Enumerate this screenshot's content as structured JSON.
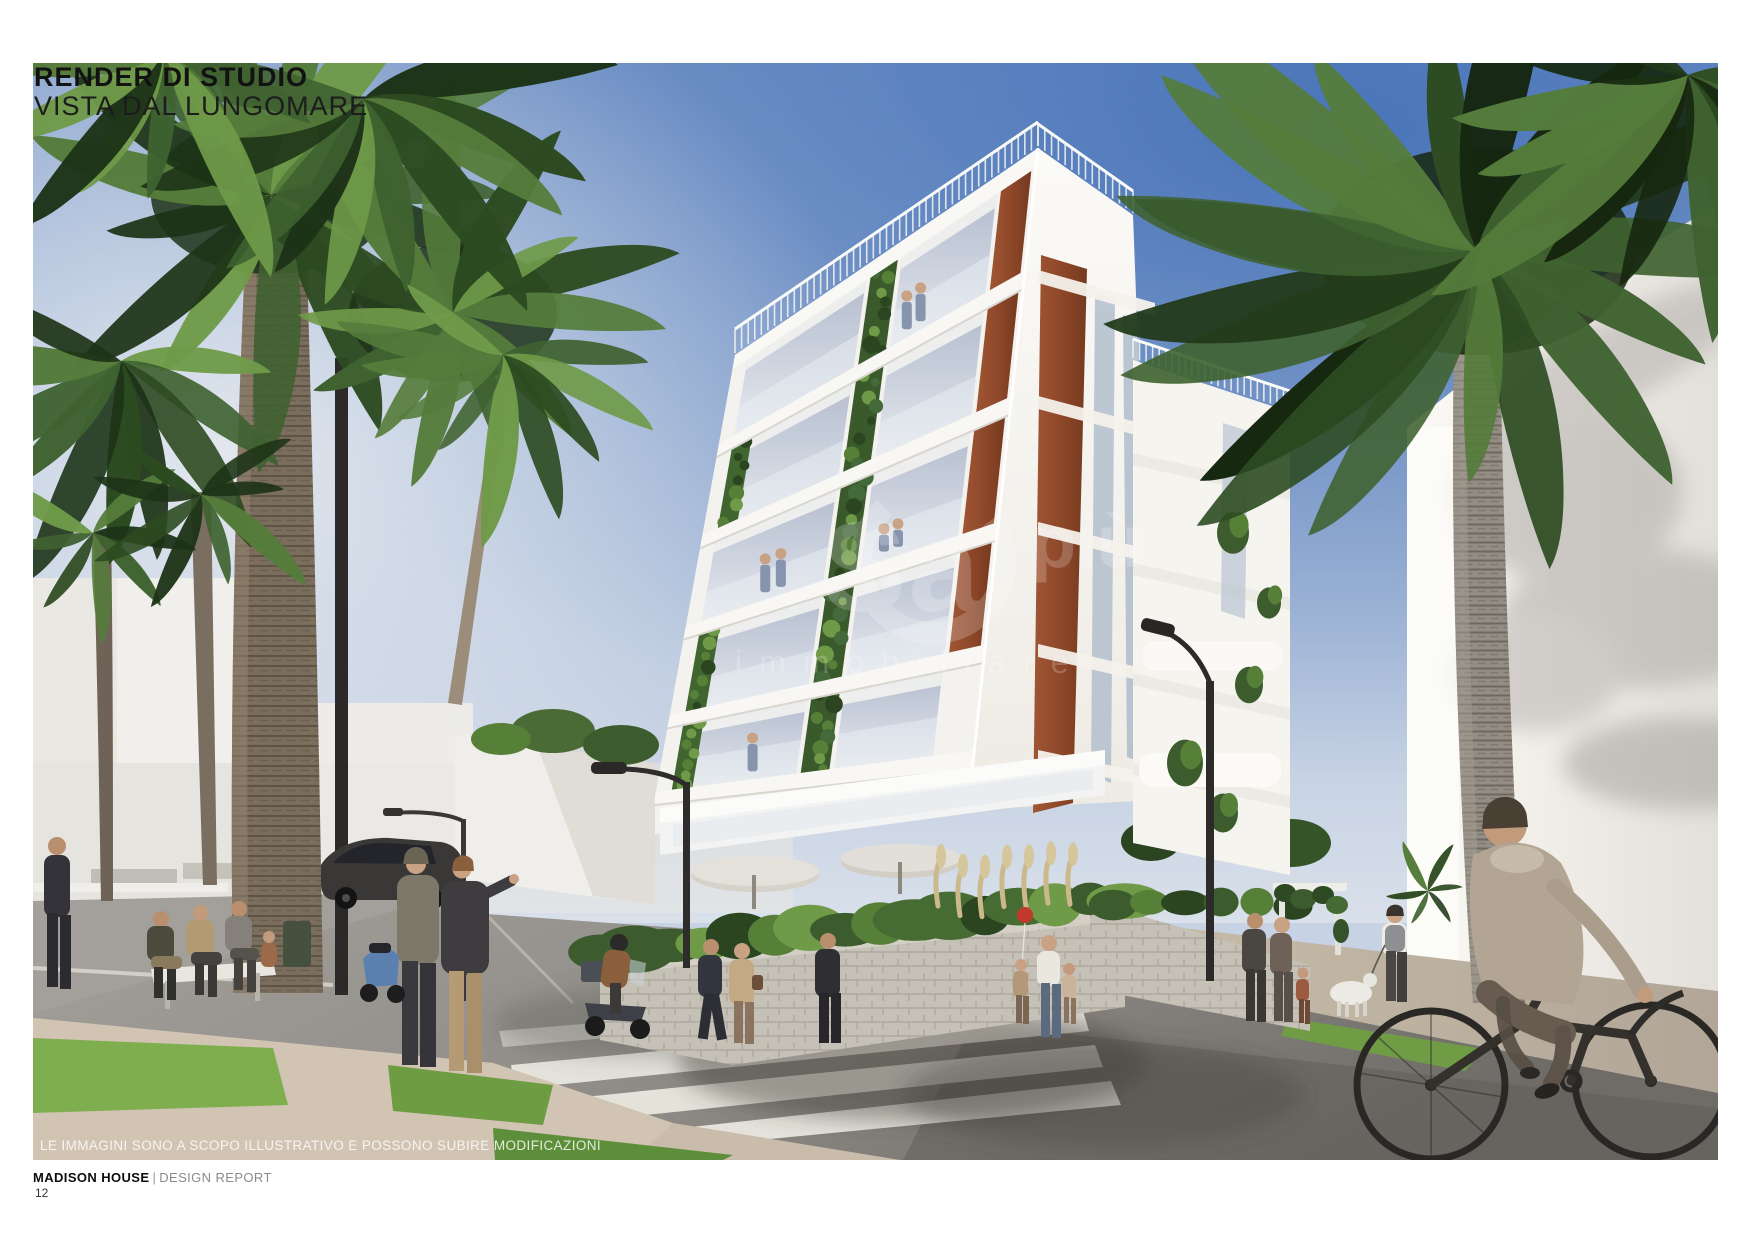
{
  "page": {
    "title_line1": "RENDER DI STUDIO",
    "title_line2": "VISTA DAL LUNGOMARE"
  },
  "image": {
    "caption": "LE IMMAGINI SONO A SCOPO ILLUSTRATIVO E POSSONO SUBIRE MODIFICAZIONI",
    "watermark": {
      "brand_large": "Sa",
      "brand_accent": "più",
      "brand_line2": "immobiliare"
    }
  },
  "footer": {
    "project": "MADISON HOUSE",
    "separator": "|",
    "document": "DESIGN REPORT",
    "page_number": "12"
  },
  "palette": {
    "sky_deep": "#4a74b8",
    "sky_pale": "#d3dcea",
    "building_white": "#f3f2ee",
    "corten_rust": "#9c4f30",
    "palm_green_dark": "#1d3317",
    "palm_green_light": "#6f9a49",
    "road_gray": "#8e8b86",
    "sidewalk_sand": "#c9bcaa"
  }
}
